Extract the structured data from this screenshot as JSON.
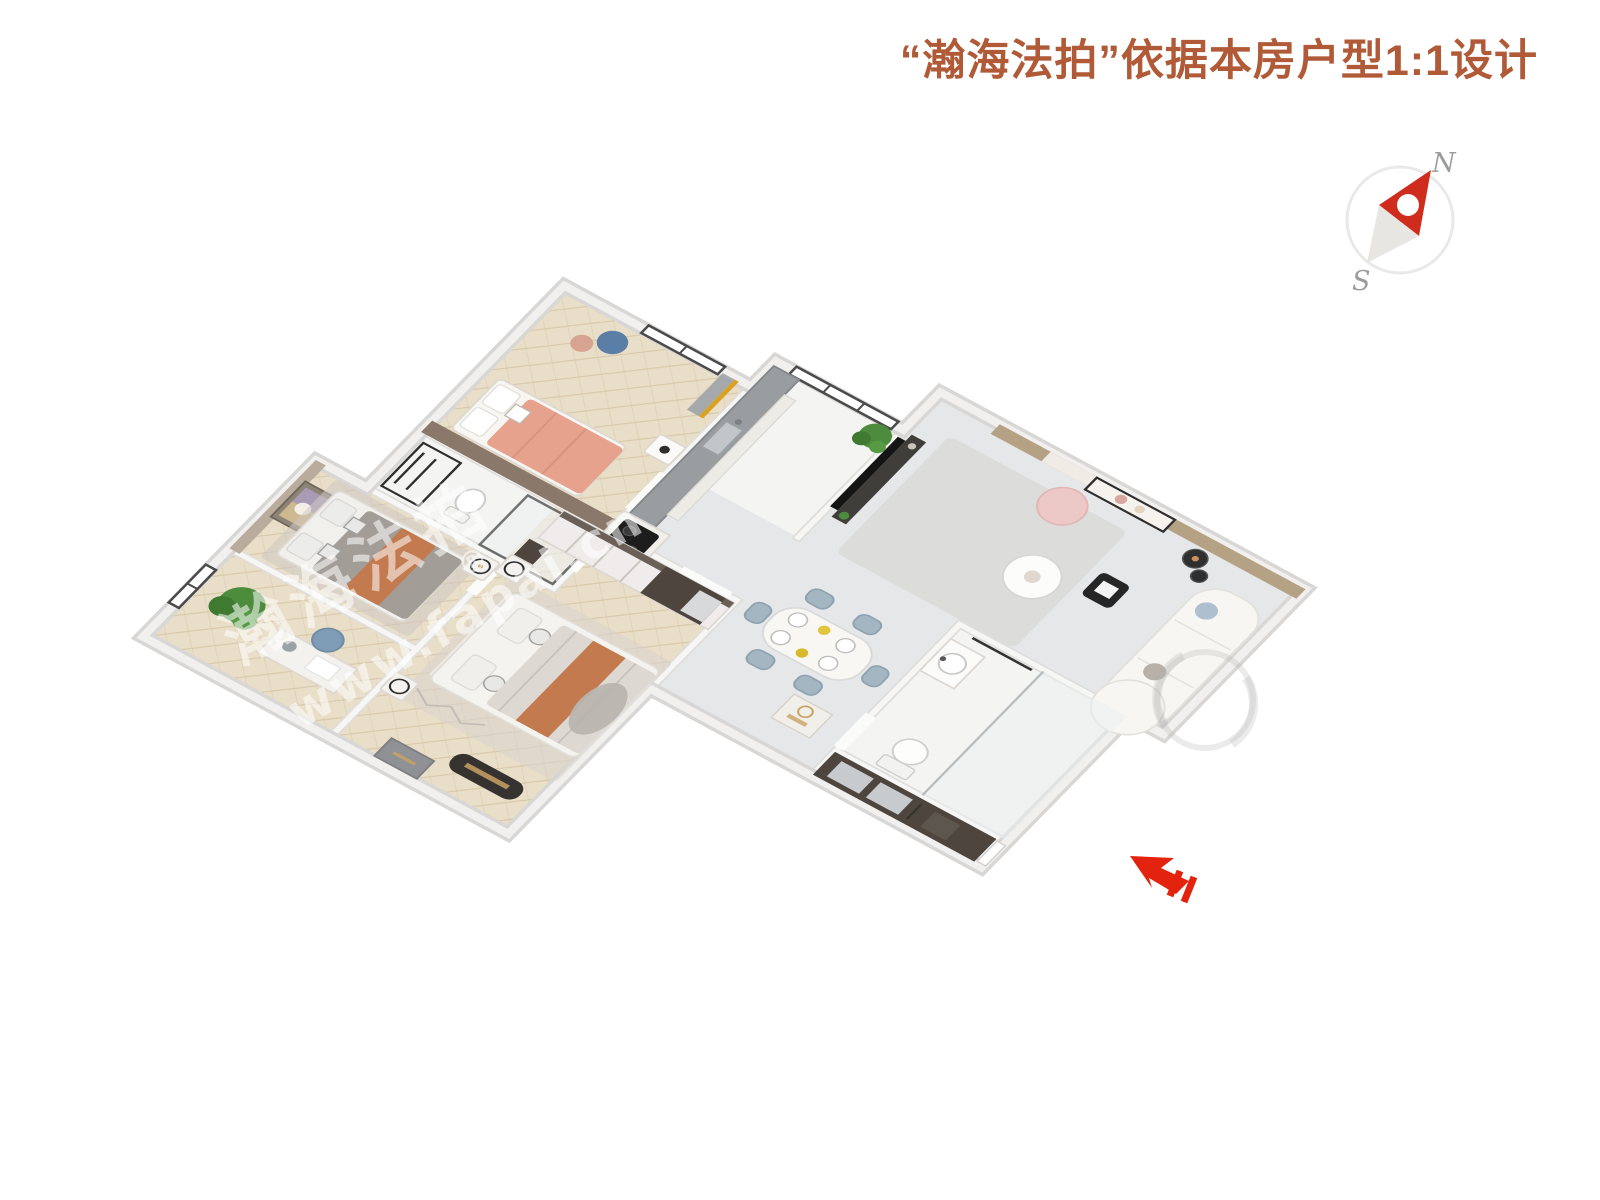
{
  "header": {
    "title": "“瀚海法拍”依据本房户型1:1设计"
  },
  "compass": {
    "north_label": "N",
    "south_label": "S"
  },
  "watermark": {
    "brand_cn": "瀚海法拍",
    "brand_url": "www.fapai.cn",
    "registered_mark": "®"
  },
  "palette": {
    "title_text": "#b05a38",
    "arrow_red": "#e3230e",
    "compass_red": "#d02c1e",
    "compass_tail": "#e7e6e3",
    "compass_ring": "#e9e9e9",
    "compass_label": "#9c9c9c",
    "wall_outer": "#d8d7d5",
    "wall_outer_top": "#f1f0ee",
    "wall_line": "#e0dedb",
    "wall_top": "#f6f6f5",
    "floor_wood": "#e9dec7",
    "floor_wood_line": "#d4c4a6",
    "floor_marble": "#e6e7e9",
    "floor_white": "#f4f4f3",
    "brown_wall": "#8a796a",
    "dark_wood": "#4d453e",
    "counter_gray": "#9a9da0",
    "sofa_white": "#f7f6f2",
    "rug_gray": "#dcdcda",
    "pouf_pink": "#ecc9c6",
    "chair_blue": "#a4b6c2",
    "bed_pink": "#e7a28d",
    "blanket_orange": "#c27a4e",
    "blanket_gray": "#a39d98",
    "plant_green": "#4d8c3c",
    "frame_dark": "#2e2e2e",
    "gold": "#c9a264",
    "window_frame": "#4a4a4a",
    "watermark_white": "rgba(255,255,255,0.55)",
    "watermark_gray": "rgba(175,175,175,0.25)"
  }
}
